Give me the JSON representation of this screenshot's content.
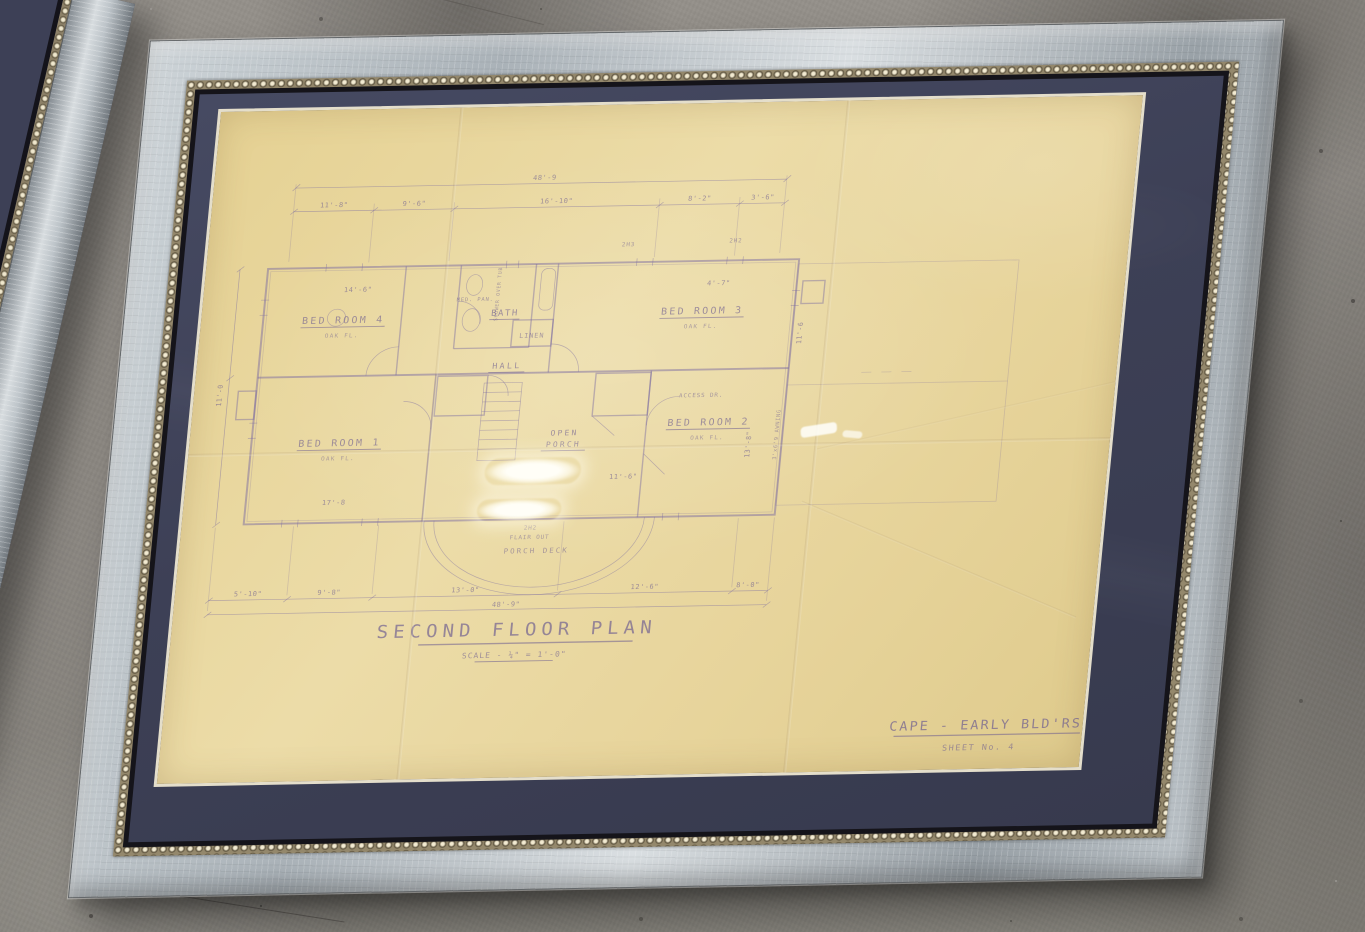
{
  "scene": {
    "setting": "two framed vintage blueprints lying on a concrete floor",
    "palette": {
      "concrete": "#8d8983",
      "frame_silver": "#c6ccd1",
      "bead_gold": "#94886c",
      "mat_navy": "#3e4157",
      "paper_cream": "#e9d7a0",
      "ink_purple": "#6e5e91"
    }
  },
  "drawing": {
    "title": "SECOND FLOOR PLAN",
    "scale_note": "SCALE - ¼\" = 1'-0\"",
    "firm": "CAPE - EARLY BLD'RS.",
    "sheet": "SHEET No. 4",
    "rooms": {
      "bedroom1": "BED ROOM 1",
      "bedroom2": "BED ROOM 2",
      "bedroom3": "BED ROOM 3",
      "bedroom4": "BED ROOM 4",
      "floor_note": "OAK FL.",
      "bath": "BATH",
      "linen": "LINEN",
      "hall": "HALL",
      "open_line1": "OPEN",
      "open_line2": "PORCH"
    },
    "annotations": {
      "porch_deck": "PORCH DECK",
      "flair_out": "FLAIR OUT",
      "access_door": "ACCESS DR.",
      "medicine_cabinet": "MED. PAN.",
      "shower": "SHOWER OVER TUB",
      "awning": "3'x6'9 AWNING"
    },
    "window_marks": {
      "m1": "2H3",
      "m2": "2H2",
      "m3": "2H2"
    },
    "dimensions": {
      "overall_top": "48'-9",
      "overall_bottom": "48'-9\"",
      "top_segments": [
        "11'-8\"",
        "9'-6\"",
        "16'-10\"",
        "8'-2\"",
        "3'-6\""
      ],
      "bottom_segments": [
        "5'-10\"",
        "9'-8\"",
        "13'-0\"",
        "12'-6\"",
        "8'-0\""
      ],
      "bedroom1_width": "17'-8",
      "bedroom2_width": "11'-6\"",
      "bedroom2_depth": "13'-8\"",
      "bedroom4_dim": "14'-6\"",
      "bedroom3_dim": "4'-7\"",
      "left_height": "11'-0",
      "right_height": "11'-6"
    }
  }
}
